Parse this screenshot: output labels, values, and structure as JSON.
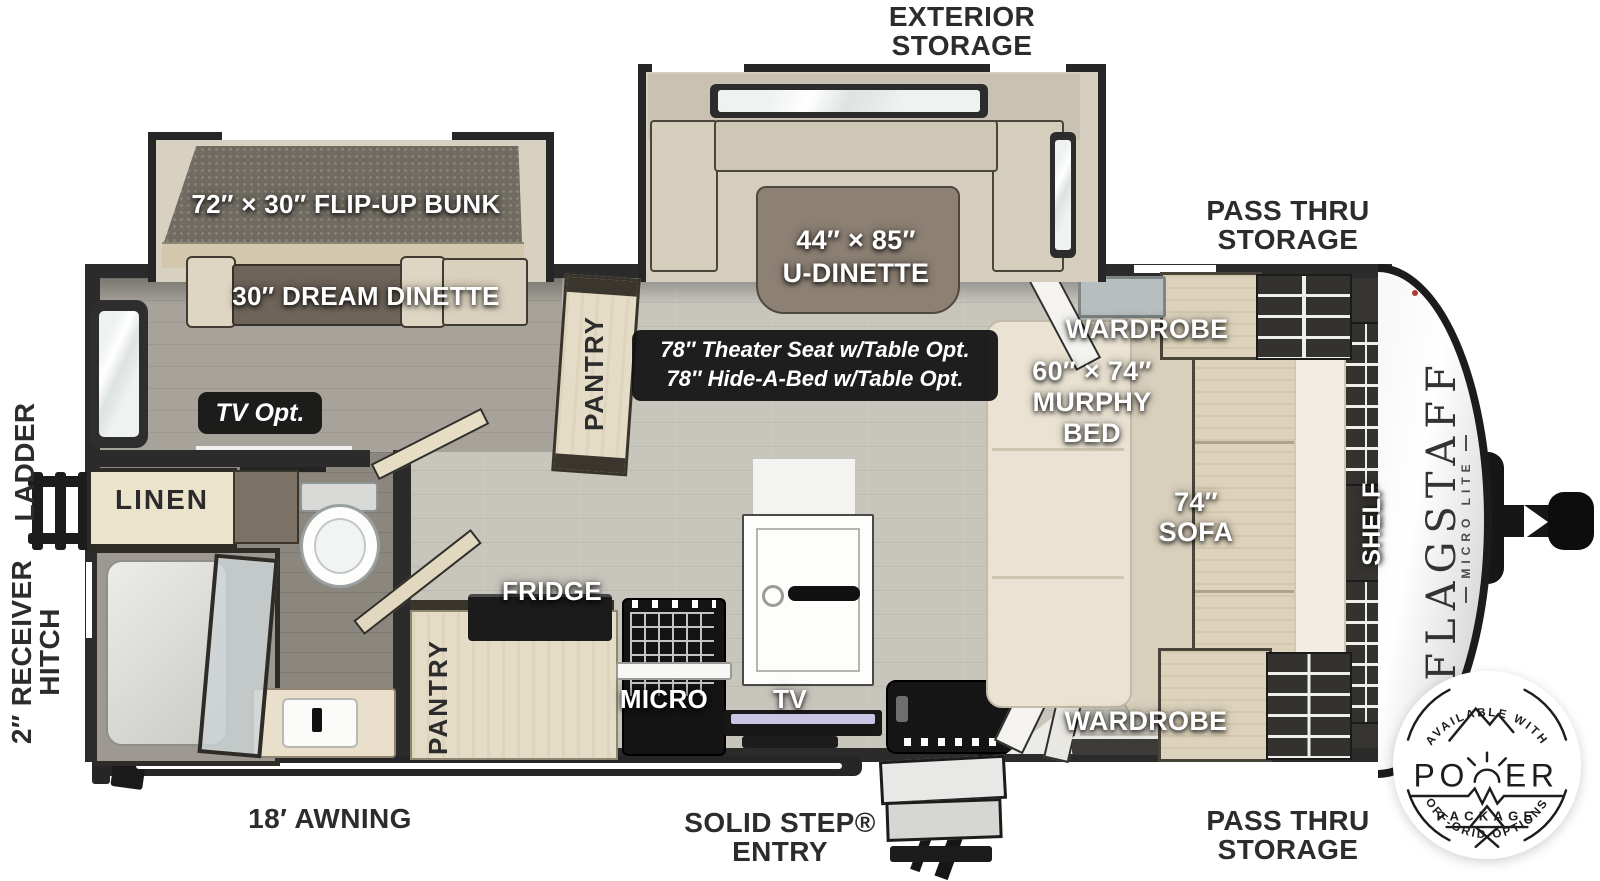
{
  "floorplan": {
    "model": {
      "brand": "FLAGSTAFF",
      "series": "MICRO LITE"
    },
    "colors": {
      "wall": "#2b2b2b",
      "floor_main": "#c8c5bd",
      "floor_rear": "#a7a39b",
      "floor_bath": "#8b877f",
      "wood": "#e5dcc7",
      "dinette_table": "#8d8174",
      "label_dark": "#2c2c2c",
      "option_badge_bg": "#161616"
    },
    "exterior": {
      "exterior_storage": [
        "EXTERIOR",
        "STORAGE"
      ],
      "pass_thru_top": [
        "PASS THRU",
        "STORAGE"
      ],
      "pass_thru_bottom": [
        "PASS THRU",
        "STORAGE"
      ],
      "awning": "18′ AWNING",
      "entry": [
        "SOLID STEP®",
        "ENTRY"
      ],
      "ladder": "LADDER",
      "receiver_hitch": [
        "2″ RECEIVER",
        "HITCH"
      ]
    },
    "rooms": {
      "flip_up_bunk": "72″ × 30″ FLIP-UP BUNK",
      "dream_dinette": "30″ DREAM DINETTE",
      "u_dinette": [
        "44″ × 85″",
        "U-DINETTE"
      ],
      "theater_opt": [
        "78″ Theater Seat w/Table Opt.",
        "78″ Hide-A-Bed w/Table Opt."
      ],
      "pantry_main": "PANTRY",
      "pantry_kitchen": "PANTRY",
      "wardrobe_top": "WARDROBE",
      "wardrobe_bottom": "WARDROBE",
      "murphy_bed": [
        "60″ × 74″",
        "MURPHY",
        "BED"
      ],
      "sofa": [
        "74″",
        "SOFA"
      ],
      "shelf": "SHELF",
      "tv_opt": "TV Opt.",
      "tv": "TV",
      "linen": "LINEN",
      "fridge": "FRIDGE",
      "micro": "MICRO"
    },
    "power_badge": {
      "arc_top": "AVAILABLE WITH",
      "power_left": "PO",
      "power_right": "ER",
      "package": "PACKAGE",
      "arc_bottom": "OFF-GRID OPTIONS"
    }
  }
}
